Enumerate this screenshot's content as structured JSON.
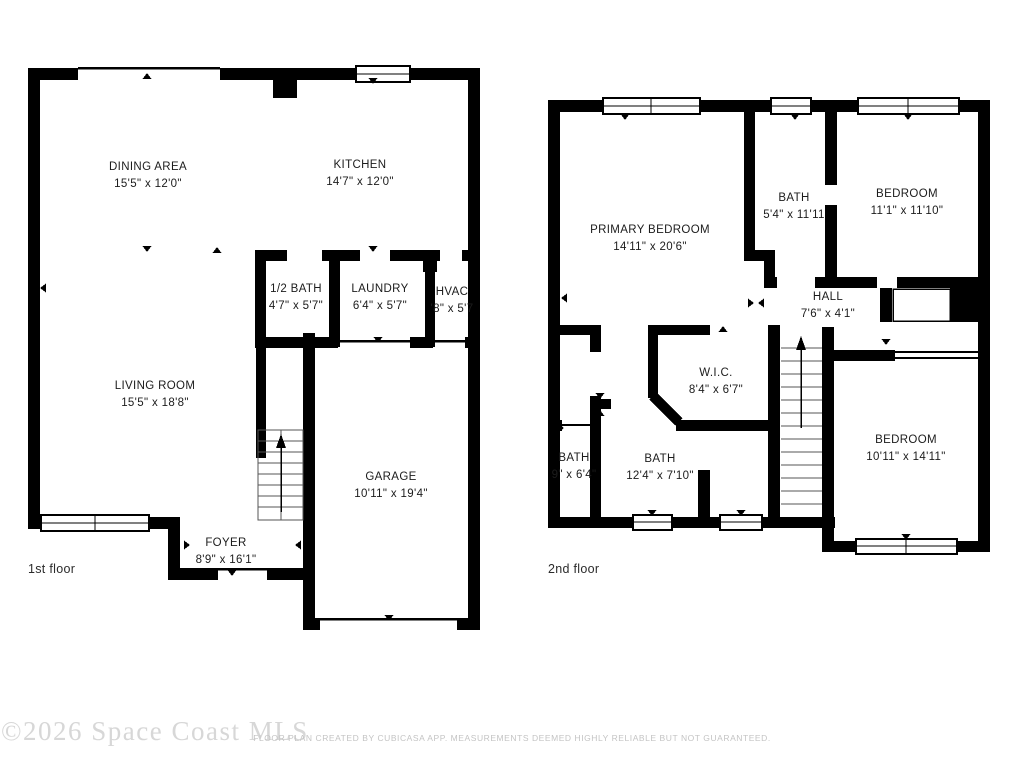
{
  "floors": [
    {
      "label": "1st floor",
      "rooms": [
        {
          "name": "DINING AREA",
          "dims": "15'5\" x 12'0\""
        },
        {
          "name": "KITCHEN",
          "dims": "14'7\" x 12'0\""
        },
        {
          "name": "1/2 BATH",
          "dims": "4'7\" x 5'7\""
        },
        {
          "name": "LAUNDRY",
          "dims": "6'4\" x 5'7\""
        },
        {
          "name": "HVAC",
          "dims": "'8\" x 5'7"
        },
        {
          "name": "LIVING ROOM",
          "dims": "15'5\" x 18'8\""
        },
        {
          "name": "GARAGE",
          "dims": "10'11\" x 19'4\""
        },
        {
          "name": "FOYER",
          "dims": "8'9\" x 16'1\""
        }
      ]
    },
    {
      "label": "2nd floor",
      "rooms": [
        {
          "name": "PRIMARY BEDROOM",
          "dims": "14'11\" x 20'6\""
        },
        {
          "name": "BATH",
          "dims": "5'4\" x 11'11"
        },
        {
          "name": "BEDROOM",
          "dims": "11'1\" x 11'10\""
        },
        {
          "name": "HALL",
          "dims": "7'6\" x 4'1\""
        },
        {
          "name": "W.I.C.",
          "dims": "8'4\" x 6'7\""
        },
        {
          "name": "BATH",
          "dims": "9\" x 6'4\""
        },
        {
          "name": "BATH",
          "dims": "12'4\" x 7'10\""
        },
        {
          "name": "BEDROOM",
          "dims": "10'11\" x 14'11\""
        }
      ]
    }
  ],
  "watermark": "©2026 Space Coast MLS",
  "disclaimer": "FLOOR PLAN CREATED BY CUBICASA APP. MEASUREMENTS DEEMED HIGHLY RELIABLE BUT NOT GUARANTEED.",
  "colors": {
    "wall": "#000000",
    "room_text": "#1c1c1c",
    "watermark": "#d7d7d7",
    "disclaimer": "#c4c4c4"
  }
}
